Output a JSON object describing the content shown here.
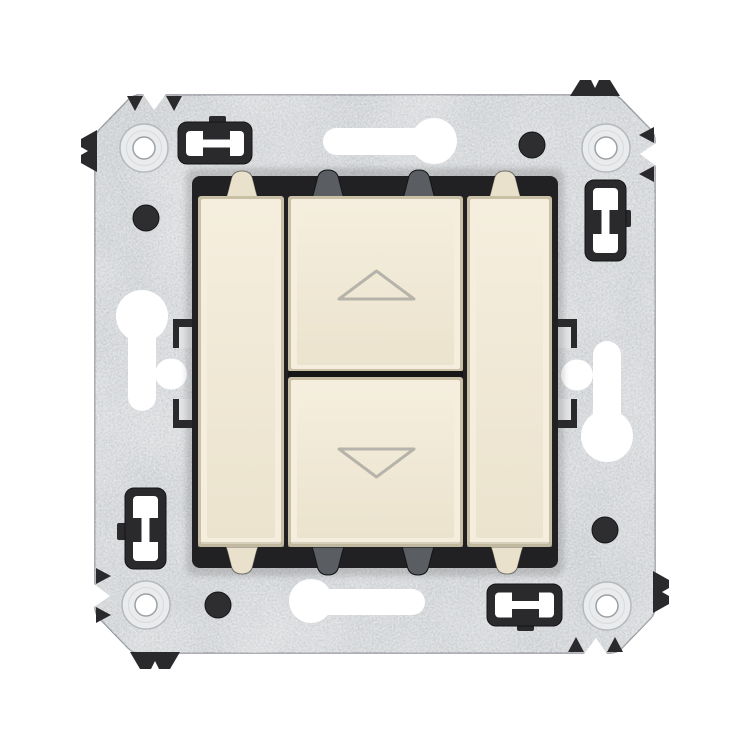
{
  "image": {
    "kind": "product-photo",
    "subject": "roller-shutter-rocker-switch-mechanism-on-metal-mounting-frame"
  },
  "icons": {
    "up": "up-arrow-icon",
    "down": "down-arrow-icon"
  },
  "colors": {
    "background": "#ffffff",
    "plate_base": "#ced1d4",
    "plate_edge": "#90949a",
    "screw_flange": "#e9ebec",
    "screw_ring": "#b6b9bc",
    "screw_mid": "#d8dbdd",
    "screw_hole": "#ffffff",
    "screw_hole_rim": "#9aa0a4",
    "hole_white": "#ffffff",
    "black_plastic": "#2a2a2c",
    "black_deep": "#141416",
    "housing_black": "#212123",
    "tab_gray": "#5a5e62",
    "tab_cream": "#e9e1cb",
    "metal_tab_light": "#e2e4e6",
    "key_edge": "#c9c0a6",
    "key_bevel_light": "#f5eedf",
    "key_face_top": "#f5eede",
    "key_face_bottom": "#ebe3cd",
    "key_shadow": "#b8af98",
    "gap_dark": "#161616",
    "arrow_stroke": "#b6b3ab",
    "dot_fill": "#2e2e30"
  }
}
